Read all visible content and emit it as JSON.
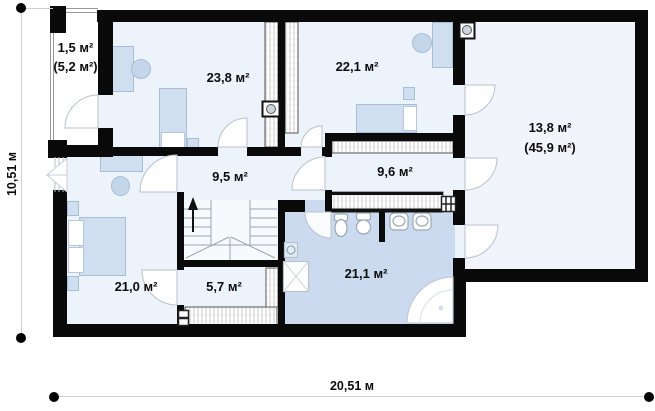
{
  "rooms": {
    "balcony": {
      "area": "1,5 м²",
      "area_total": "(5,2 м²)"
    },
    "bedroom1": {
      "area": "23,8 м²"
    },
    "bedroom2": {
      "area": "22,1 м²"
    },
    "attic_space": {
      "area": "13,8 м²",
      "area_total": "(45,9 м²)"
    },
    "hallway": {
      "area": "9,5 м²"
    },
    "closet": {
      "area": "9,6 м²"
    },
    "bedroom3": {
      "area": "21,0 м²"
    },
    "corridor": {
      "area": "5,7 м²"
    },
    "bathroom": {
      "area": "21,1 м²"
    }
  },
  "dimensions": {
    "overall_width": "20,51 м",
    "overall_height": "10,51 м"
  },
  "colors": {
    "wall": "#0a0a0a",
    "room_floor": "#edf3fa",
    "attic_floor": "#f1f5fb",
    "bathroom_floor": "#cbdaee",
    "furniture": "#cfdfef",
    "dimension_line": "#cfcfcf"
  }
}
